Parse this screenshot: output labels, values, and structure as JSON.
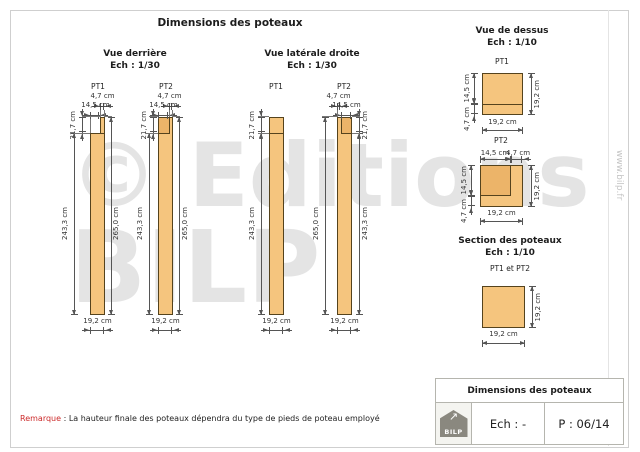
{
  "main_title": "Dimensions des poteaux",
  "views": {
    "back": {
      "title": "Vue derrière",
      "scale": "Ech : 1/30",
      "pt1": "PT1",
      "pt2": "PT2"
    },
    "side": {
      "title": "Vue latérale droite",
      "scale": "Ech : 1/30",
      "pt1": "PT1",
      "pt2": "PT2"
    },
    "top": {
      "title": "Vue de dessus",
      "scale": "Ech : 1/10",
      "pt1": "PT1",
      "pt2": "PT2"
    },
    "section": {
      "title": "Section des poteaux",
      "scale": "Ech : 1/10",
      "subtitle": "PT1 et PT2"
    }
  },
  "dims": {
    "d47": "4,7 cm",
    "d145": "14,5 cm",
    "d192": "19,2 cm",
    "d217": "21,7 cm",
    "d2433": "243,3 cm",
    "d2650": "265,0 cm"
  },
  "remark": {
    "label": "Remarque",
    "rest": " : La hauteur finale des poteaux dépendra du type de pieds de poteau employé"
  },
  "title_block": {
    "title": "Dimensions des poteaux",
    "ech": "Ech : -",
    "page": "P : 06/14",
    "logo_text": "BILP",
    "logo_arrow": "↗"
  },
  "watermark": {
    "line1": "© Editions",
    "line2": "BILP",
    "website": "www.bilp.fr"
  },
  "colors": {
    "wood": "#f5c57e",
    "wood_dark": "#ecb469",
    "wood_border": "#55431d",
    "dim_line": "#555555",
    "remark_red": "#cc2a2a",
    "watermark_gray": "#e4e4e4"
  }
}
